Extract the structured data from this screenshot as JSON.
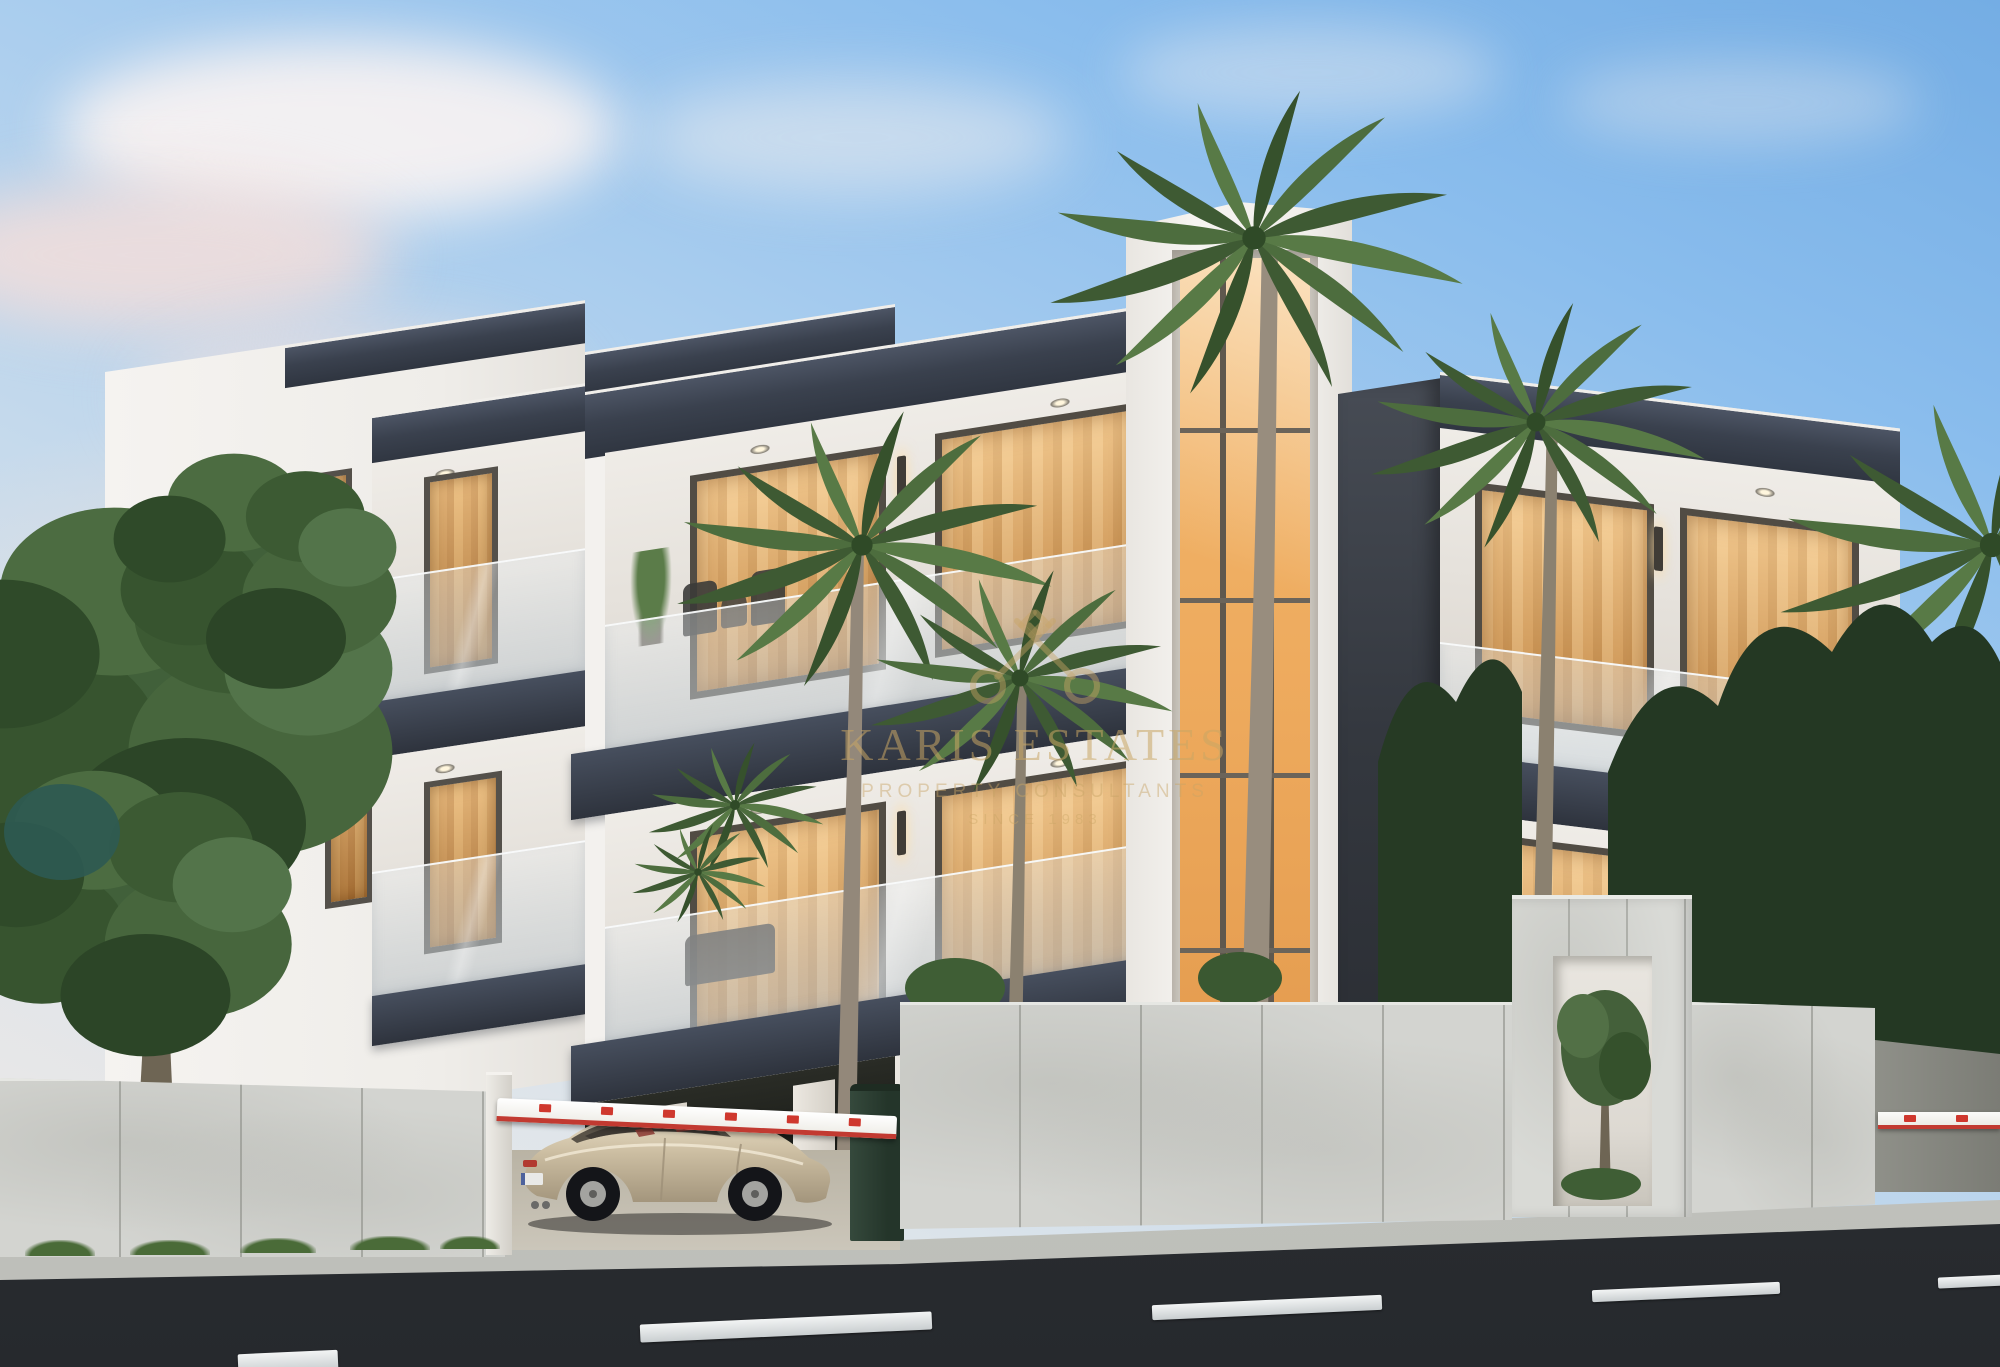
{
  "watermark": {
    "icon": "crossed-keys-icon",
    "line1": "KARIS ESTATES",
    "line2": "PROPERTY CONSULTANTS",
    "line3": "SINCE 1983",
    "color": "#c8a565"
  },
  "scene": {
    "type": "exterior architectural 3D render",
    "time_of_day": "dusk",
    "description": "Modern three-storey residential complex: white render with charcoal feature bands, recessed glass balconies lit warm amber, central glazed stair tower, precast concrete boundary wall with pedestrian portal, gated driveway with boom barrier, parked champagne sedan, palm trees and mature landscaping, asphalt street in the foreground under a pastel dusk sky",
    "buildings": {
      "left": "white block with recessed glass balconies and small windows",
      "center": "white block with full-width charcoal-framed balconies over carport",
      "tower": "white stair tower with amber glazed curtain wall",
      "right": "white block with dark stone corner column and recessed balconies"
    },
    "site": {
      "boundary_wall": "precast concrete panels",
      "pedestrian_gate": "concrete portal frame with ornamental tree",
      "vehicle_barriers": 2,
      "parked_car": "champagne sedan",
      "waste_bin": "dark green wheelie bin",
      "driveway": "paved carport"
    },
    "vegetation": {
      "left_tree": "mature deciduous tree",
      "palms": 6,
      "background": "dense dark shrubs and trees"
    },
    "street": {
      "surface": "dark asphalt",
      "markings": "white dashed centre line",
      "sidewalk": "light concrete kerb"
    }
  },
  "palette": {
    "sky_top": "#79b2e7",
    "sky_horizon": "#efe9e6",
    "cloud_pink": "#f4ded8",
    "building_white": "#f0eeea",
    "charcoal_band": "#3a414e",
    "window_glow": "#e2a55c",
    "tower_glass": "#eeab60",
    "concrete_wall": "#d3d4d0",
    "asphalt": "#2f3337",
    "foliage_green": "#41603a",
    "palm_green": "#4d6d3e",
    "watermark_gold": "#c8a565",
    "barrier_red": "#c93a30",
    "car_champagne": "#cdbfa3"
  }
}
